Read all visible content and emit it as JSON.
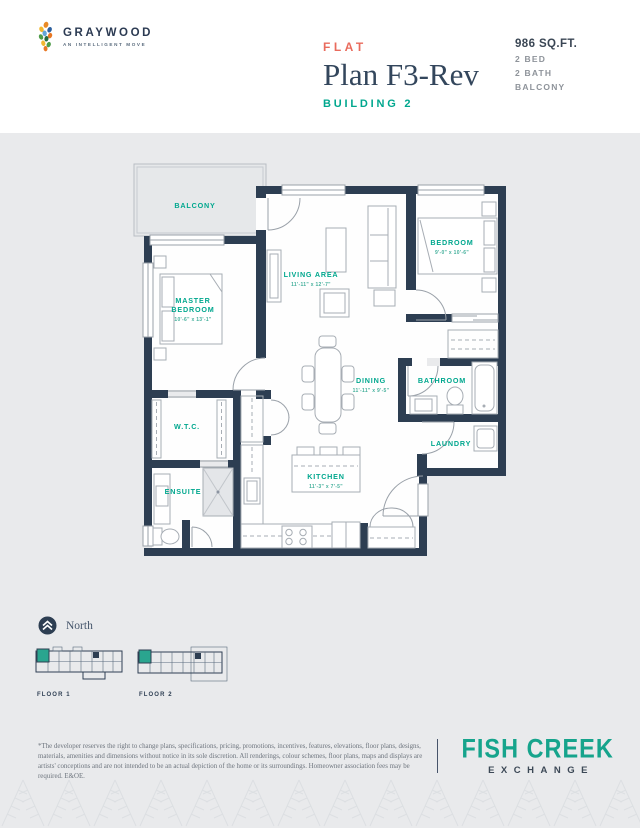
{
  "logo": {
    "name": "GRAYWOOD",
    "tagline": "AN INTELLIGENT MOVE"
  },
  "header": {
    "unit_type": "FLAT",
    "plan_name": "Plan F3-Rev",
    "building": "BUILDING 2",
    "area": "986 SQ.FT.",
    "features": [
      "2 BED",
      "2 BATH",
      "BALCONY"
    ]
  },
  "colors": {
    "accent_teal": "#00a78e",
    "accent_coral": "#e96b5d",
    "wall_navy": "#2d3e52",
    "page_gray": "#e9eaec"
  },
  "floorplan": {
    "balcony": {
      "label": "BALCONY"
    },
    "master_bedroom": {
      "line1": "MASTER",
      "line2": "BEDROOM",
      "dims": "10'-6\" x 13'-1\""
    },
    "living_area": {
      "label": "LIVING AREA",
      "dims": "11'-11\" x 12'-7\""
    },
    "bedroom": {
      "label": "BEDROOM",
      "dims": "9'-0\" x 10'-6\""
    },
    "dining": {
      "label": "DINING",
      "dims": "11'-11\" x 9'-5\""
    },
    "bathroom": {
      "label": "BATHROOM"
    },
    "laundry": {
      "label": "LAUNDRY"
    },
    "wtc": {
      "label": "W.T.C."
    },
    "ensuite": {
      "label": "ENSUITE"
    },
    "kitchen": {
      "label": "KITCHEN",
      "dims": "11'-3\" x 7'-5\""
    }
  },
  "footer": {
    "north_label": "North",
    "floor_labels": [
      "FLOOR 1",
      "FLOOR 2"
    ],
    "disclaimer": "*The developer reserves the right to change plans, specifications, pricing, promotions, incentives, features, elevations, floor plans, designs, materials, amenities and dimensions without notice in its sole discretion. All renderings, colour schemes, floor plans, maps and displays are artists' conceptions and are not intended to be an actual depiction of the home or its surroundings. Homeowner association fees may be required. E&OE.",
    "brand": {
      "line1": "FISH CREEK",
      "line2": "EXCHANGE"
    }
  }
}
